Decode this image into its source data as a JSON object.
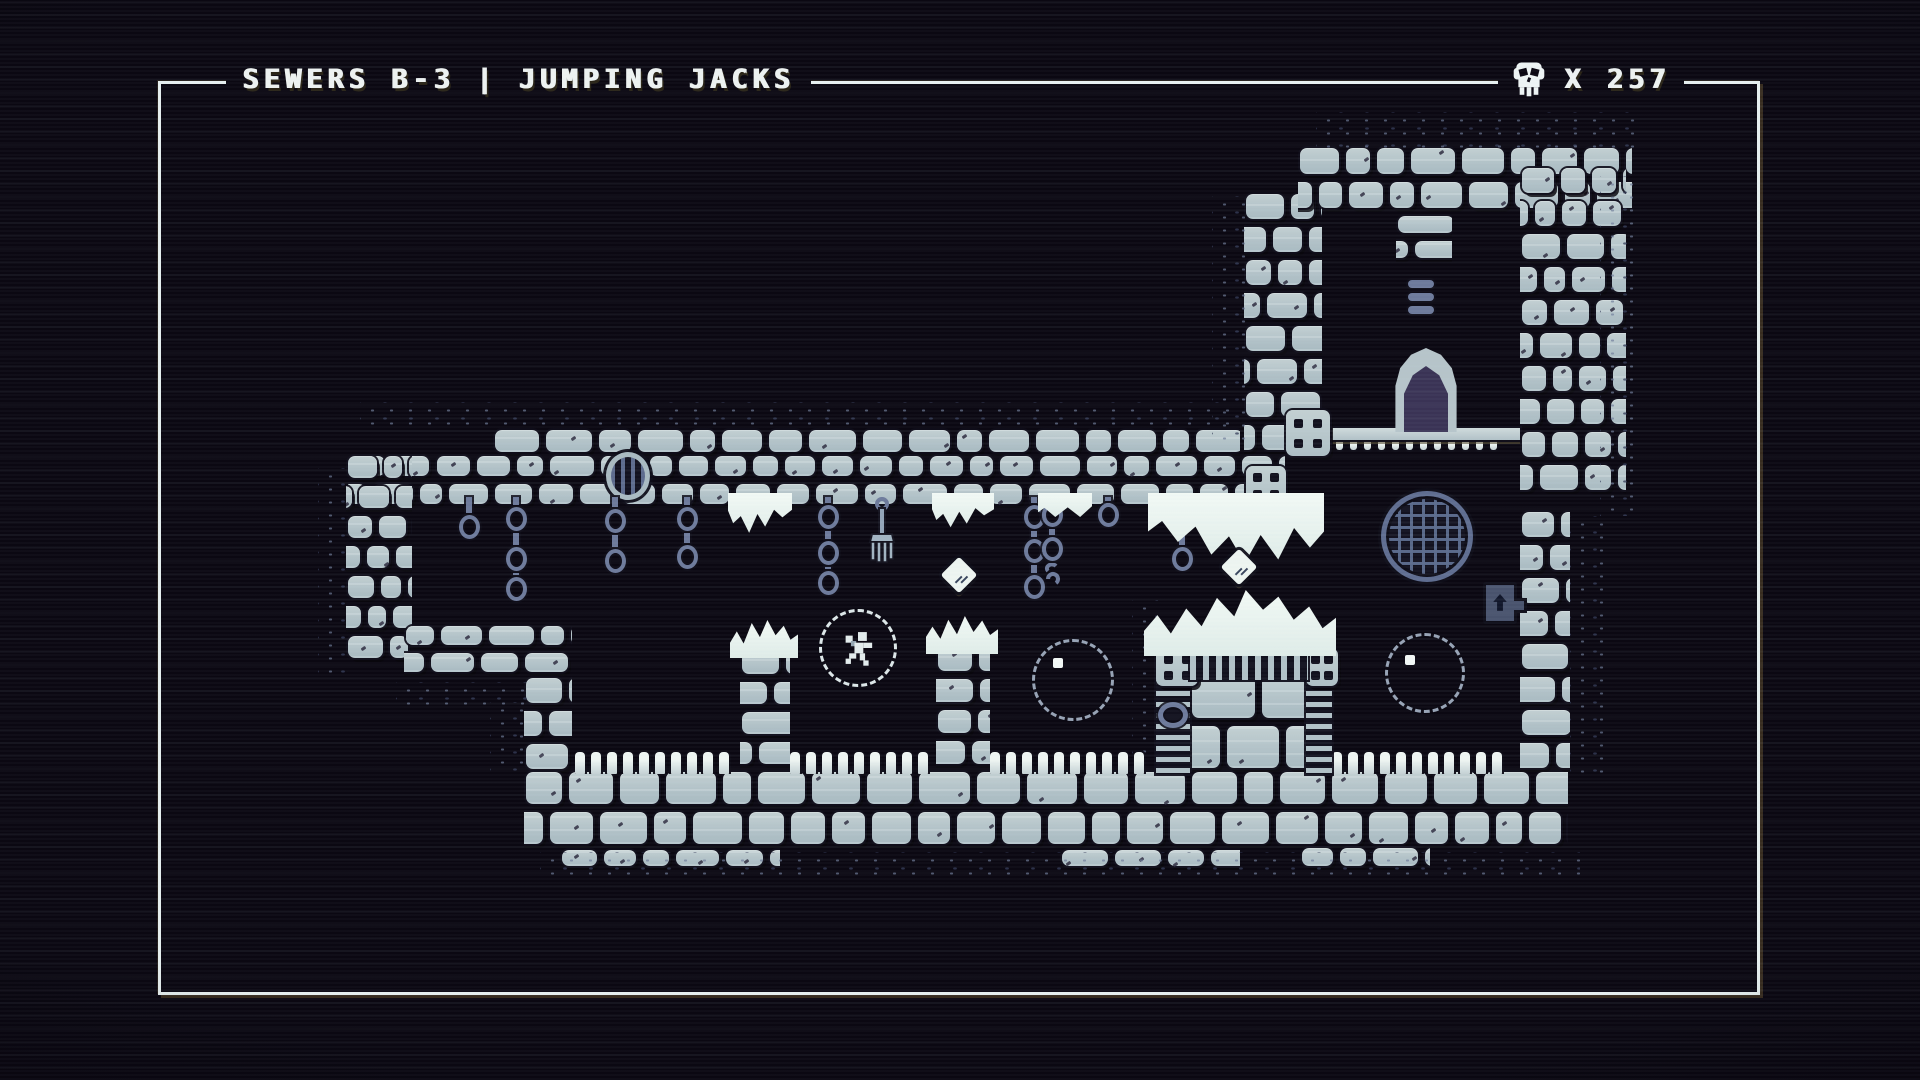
{
  "hud": {
    "level_title": "SEWERS B-3 | JUMPING JACKS",
    "skull_count": "X 257",
    "skull_icon": "skull-icon"
  },
  "scene": {
    "description": "1-bit pixel-art sewer dungeon map",
    "features": {
      "door": "arched-exit-door",
      "manhole": "round-sewer-grate",
      "vent": "oval-ceiling-vent",
      "sign": "up-arrow-exit-sign",
      "traps": "hanging-chains-and-fork",
      "player": "character-in-bubble",
      "bubbles": "two-empty-bubbles",
      "pickups": "two-spinning-diamonds",
      "foam": "white-sewer-foam-patches"
    }
  },
  "colors": {
    "background": "#0b0812",
    "tile": "#b6c4c9",
    "tile_highlight": "#ccd7d9",
    "outline": "#15141f",
    "warm_shadow": "#51483a",
    "slate": "#6d7a9b",
    "foam": "#e9f3ef",
    "door_interior": "#3a3355",
    "frame": "#e6efef"
  }
}
